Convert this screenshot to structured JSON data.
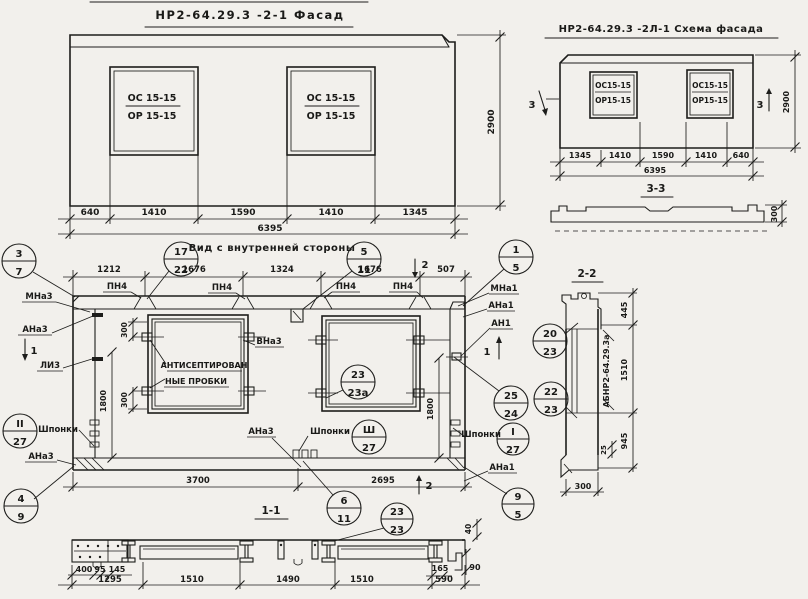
{
  "facade": {
    "title": "НР2-64.29.3 -2-1 Фасад",
    "win_top": "ОС 15-15",
    "win_bottom": "ОР 15-15",
    "dims": [
      "640",
      "1410",
      "1590",
      "1410",
      "1345"
    ],
    "total": "6395",
    "height": "2900"
  },
  "scheme": {
    "title": "НР2-64.29.3 -2Л-1 Схема фасада",
    "win_top": "ОС15-15",
    "win_bottom": "ОР15-15",
    "dims": [
      "1345",
      "1410",
      "1590",
      "1410",
      "640"
    ],
    "total": "6395",
    "height": "2900",
    "cut_label": "3",
    "section_label": "3-3",
    "section_thickness": "300"
  },
  "inner": {
    "title": "Вид с внутренней стороны",
    "dims_top": [
      "1212",
      "1676",
      "1324",
      "1676",
      "507"
    ],
    "loop_label": "ПН4",
    "dim_300": "300",
    "dim_1800": "1800",
    "dim_3700": "3700",
    "dim_2695": "2695",
    "label_mna3": "МНа3",
    "label_ana3": "АНа3",
    "label_li3": "ЛИ3",
    "label_vna3": "ВНа3",
    "label_shponki": "Шпонки",
    "label_mna1": "МНа1",
    "label_ana1": "АНа1",
    "label_an1": "АН1",
    "plug_note_1": "АНТИСЕПТИРОВАН",
    "plug_note_2": "НЫЕ ПРОБКИ",
    "cut1_label": "1",
    "cut2_label": "2",
    "section_label": "1-1"
  },
  "callouts": {
    "k3_7": {
      "top": "3",
      "bot": "7"
    },
    "k17_22": {
      "top": "17",
      "bot": "22"
    },
    "k5_11": {
      "top": "5",
      "bot": "11"
    },
    "k1_5": {
      "top": "1",
      "bot": "5"
    },
    "k23_23a": {
      "top": "23",
      "bot": "23а"
    },
    "k20_23": {
      "top": "20",
      "bot": "23"
    },
    "k25_24": {
      "top": "25",
      "bot": "24"
    },
    "k22_23": {
      "top": "22",
      "bot": "23"
    },
    "kI_27": {
      "top": "I",
      "bot": "27"
    },
    "kII_27": {
      "top": "II",
      "bot": "27"
    },
    "kIII_27": {
      "top": "Ш",
      "bot": "27"
    },
    "k4_9": {
      "top": "4",
      "bot": "9"
    },
    "k6_11": {
      "top": "6",
      "bot": "11"
    },
    "k23_23": {
      "top": "23",
      "bot": "23"
    },
    "k9_5": {
      "top": "9",
      "bot": "5"
    }
  },
  "section22": {
    "title": "2-2",
    "dim_445": "445",
    "dim_1510": "1510",
    "dim_945": "945",
    "dim_25": "25",
    "dim_300": "300",
    "mark": "АБНР2-64.29.3а"
  },
  "strip": {
    "dims_small": [
      "400",
      "95",
      "145"
    ],
    "dims_main": [
      "1295",
      "1510",
      "1490",
      "1510",
      "590"
    ],
    "dim_165": "165",
    "dim_90": "90",
    "dim_40": "40"
  }
}
